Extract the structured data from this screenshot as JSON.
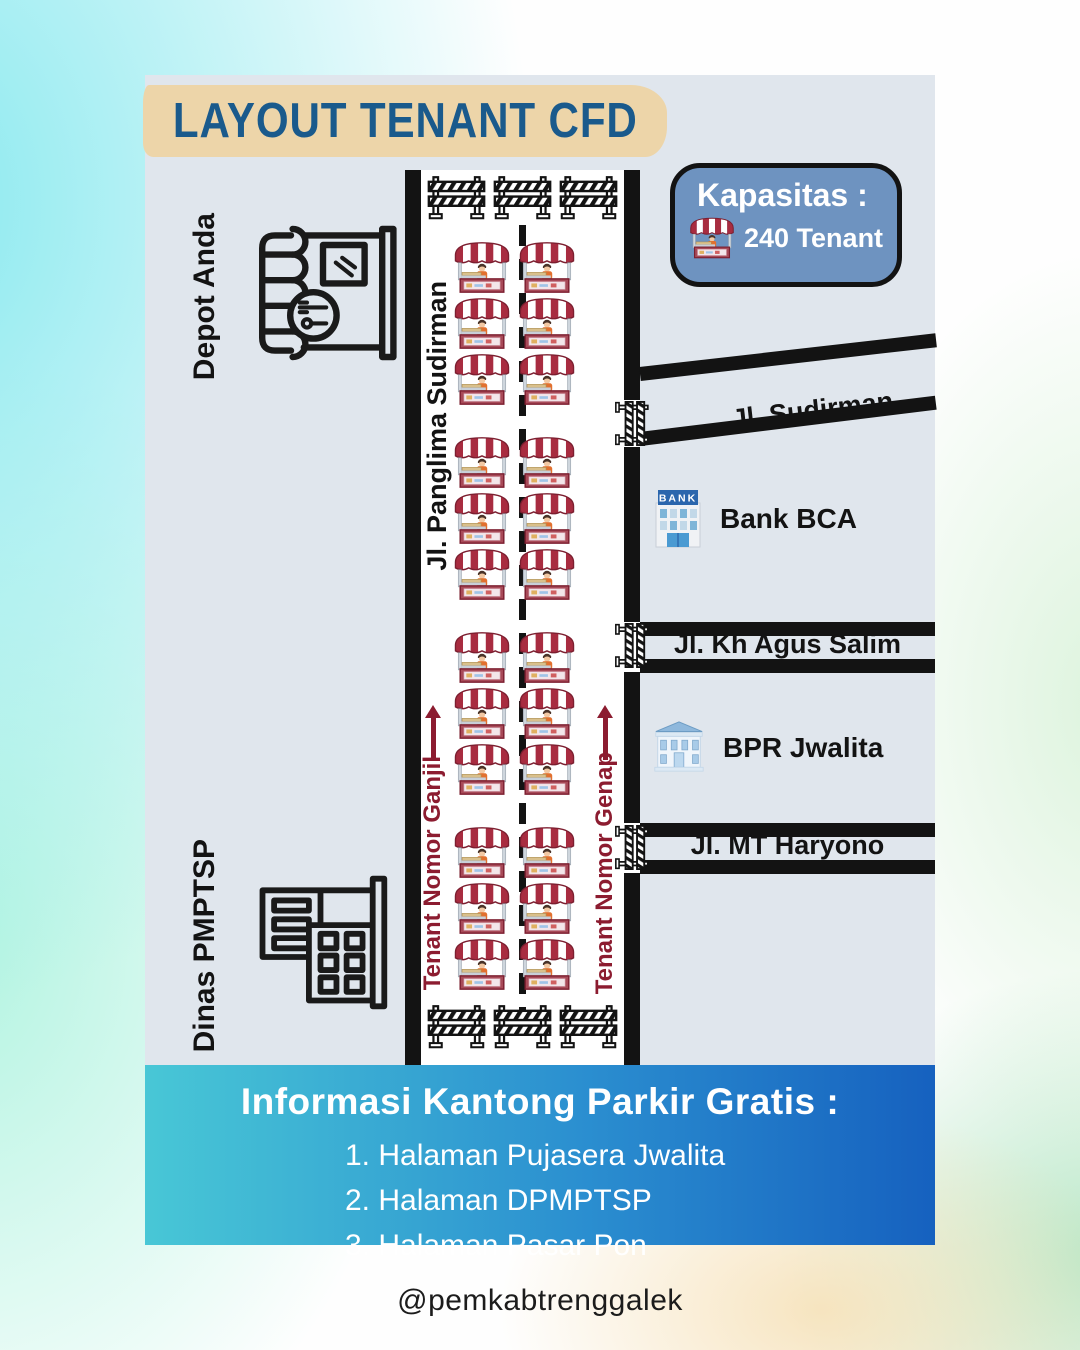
{
  "title": "LAYOUT TENANT CFD",
  "capacity": {
    "label": "Kapasitas :",
    "value": "240 Tenant"
  },
  "main_road": {
    "name": "Jl. Panglima Sudirman",
    "lane_left": "Tenant Nomor Ganjil",
    "lane_right": "Tenant Nomor Genap"
  },
  "landmarks_left": [
    {
      "name": "Depot Anda",
      "icon": "restaurant-storefront-icon"
    },
    {
      "name": "Dinas PMPTSP",
      "icon": "government-office-icon"
    }
  ],
  "side_streets": [
    {
      "name": "Jl. Sudirman"
    },
    {
      "name": "Jl. Kh Agus Salim"
    },
    {
      "name": "Jl. MT Haryono"
    }
  ],
  "landmarks_right": [
    {
      "name": "Bank BCA",
      "sign": "BANK",
      "icon": "bank-building-icon"
    },
    {
      "name": "BPR Jwalita",
      "icon": "classical-bank-icon"
    }
  ],
  "layout": {
    "stalls": {
      "groups": 4,
      "rows_per_group": 3,
      "columns": 2,
      "total_icons": 24
    },
    "barriers": {
      "top": 3,
      "bottom": 3,
      "side": 3
    }
  },
  "parking_info": {
    "heading": "Informasi Kantong Parkir Gratis :",
    "items": [
      "1. Halaman Pujasera Jwalita",
      "2. Halaman DPMPTSP",
      "3. Halaman Pasar Pon"
    ]
  },
  "footer": {
    "handle": "@pemkabtrenggalek"
  },
  "colors": {
    "panel": "#e0e6ed",
    "title_text": "#1a5a8c",
    "title_band": "#edd5a9",
    "road_border": "#131313",
    "accent_red": "#8c1c30",
    "badge_fill": "#6e93c0",
    "info_gradient_start": "#48c7d6",
    "info_gradient_end": "#1661bf"
  }
}
